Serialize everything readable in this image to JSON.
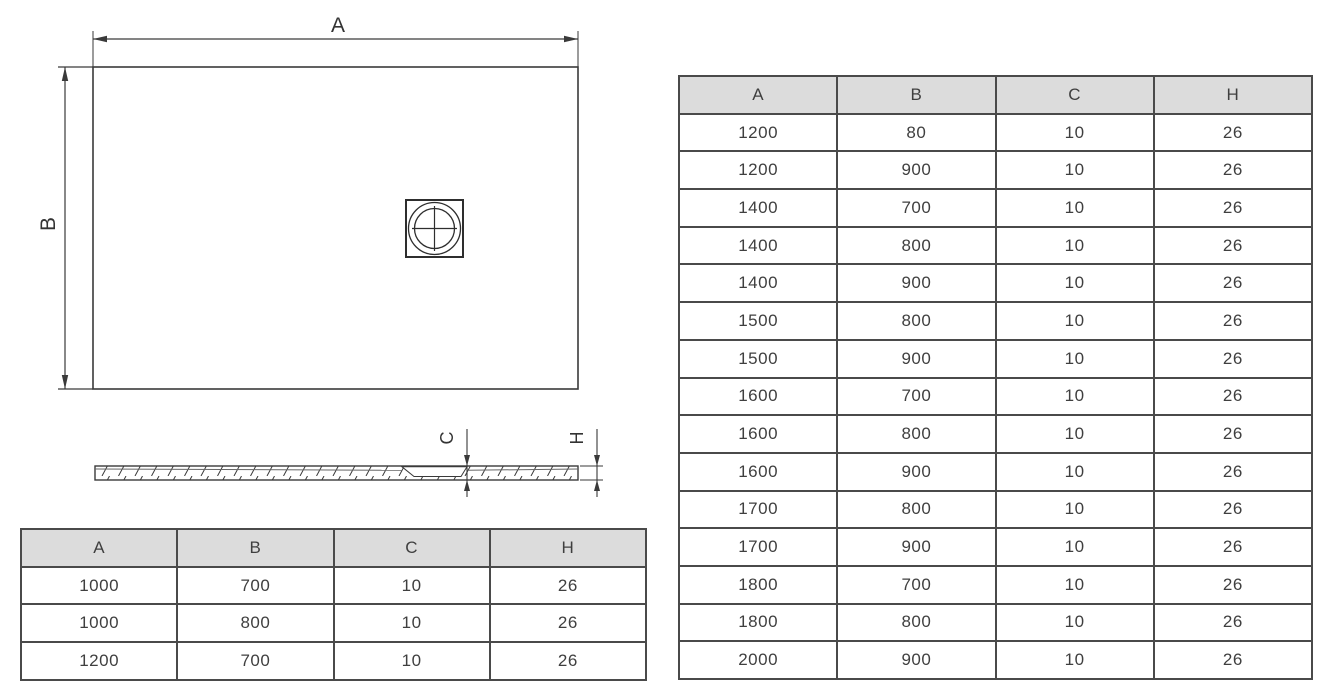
{
  "drawing": {
    "top_view": {
      "width_label": "A",
      "height_label": "B"
    },
    "section_view": {
      "recess_depth_label": "C",
      "total_height_label": "H"
    }
  },
  "tables": {
    "left": {
      "headers": [
        "A",
        "B",
        "C",
        "H"
      ],
      "rows": [
        [
          "1000",
          "700",
          "10",
          "26"
        ],
        [
          "1000",
          "800",
          "10",
          "26"
        ],
        [
          "1200",
          "700",
          "10",
          "26"
        ]
      ]
    },
    "right": {
      "headers": [
        "A",
        "B",
        "C",
        "H"
      ],
      "rows": [
        [
          "1200",
          "80",
          "10",
          "26"
        ],
        [
          "1200",
          "900",
          "10",
          "26"
        ],
        [
          "1400",
          "700",
          "10",
          "26"
        ],
        [
          "1400",
          "800",
          "10",
          "26"
        ],
        [
          "1400",
          "900",
          "10",
          "26"
        ],
        [
          "1500",
          "800",
          "10",
          "26"
        ],
        [
          "1500",
          "900",
          "10",
          "26"
        ],
        [
          "1600",
          "700",
          "10",
          "26"
        ],
        [
          "1600",
          "800",
          "10",
          "26"
        ],
        [
          "1600",
          "900",
          "10",
          "26"
        ],
        [
          "1700",
          "800",
          "10",
          "26"
        ],
        [
          "1700",
          "900",
          "10",
          "26"
        ],
        [
          "1800",
          "700",
          "10",
          "26"
        ],
        [
          "1800",
          "800",
          "10",
          "26"
        ],
        [
          "2000",
          "900",
          "10",
          "26"
        ]
      ]
    }
  },
  "colors": {
    "line": "#3a3a3a",
    "table_border": "#4a4a4a",
    "header_bg": "#dcdcdc",
    "text": "#3f3f3f"
  }
}
